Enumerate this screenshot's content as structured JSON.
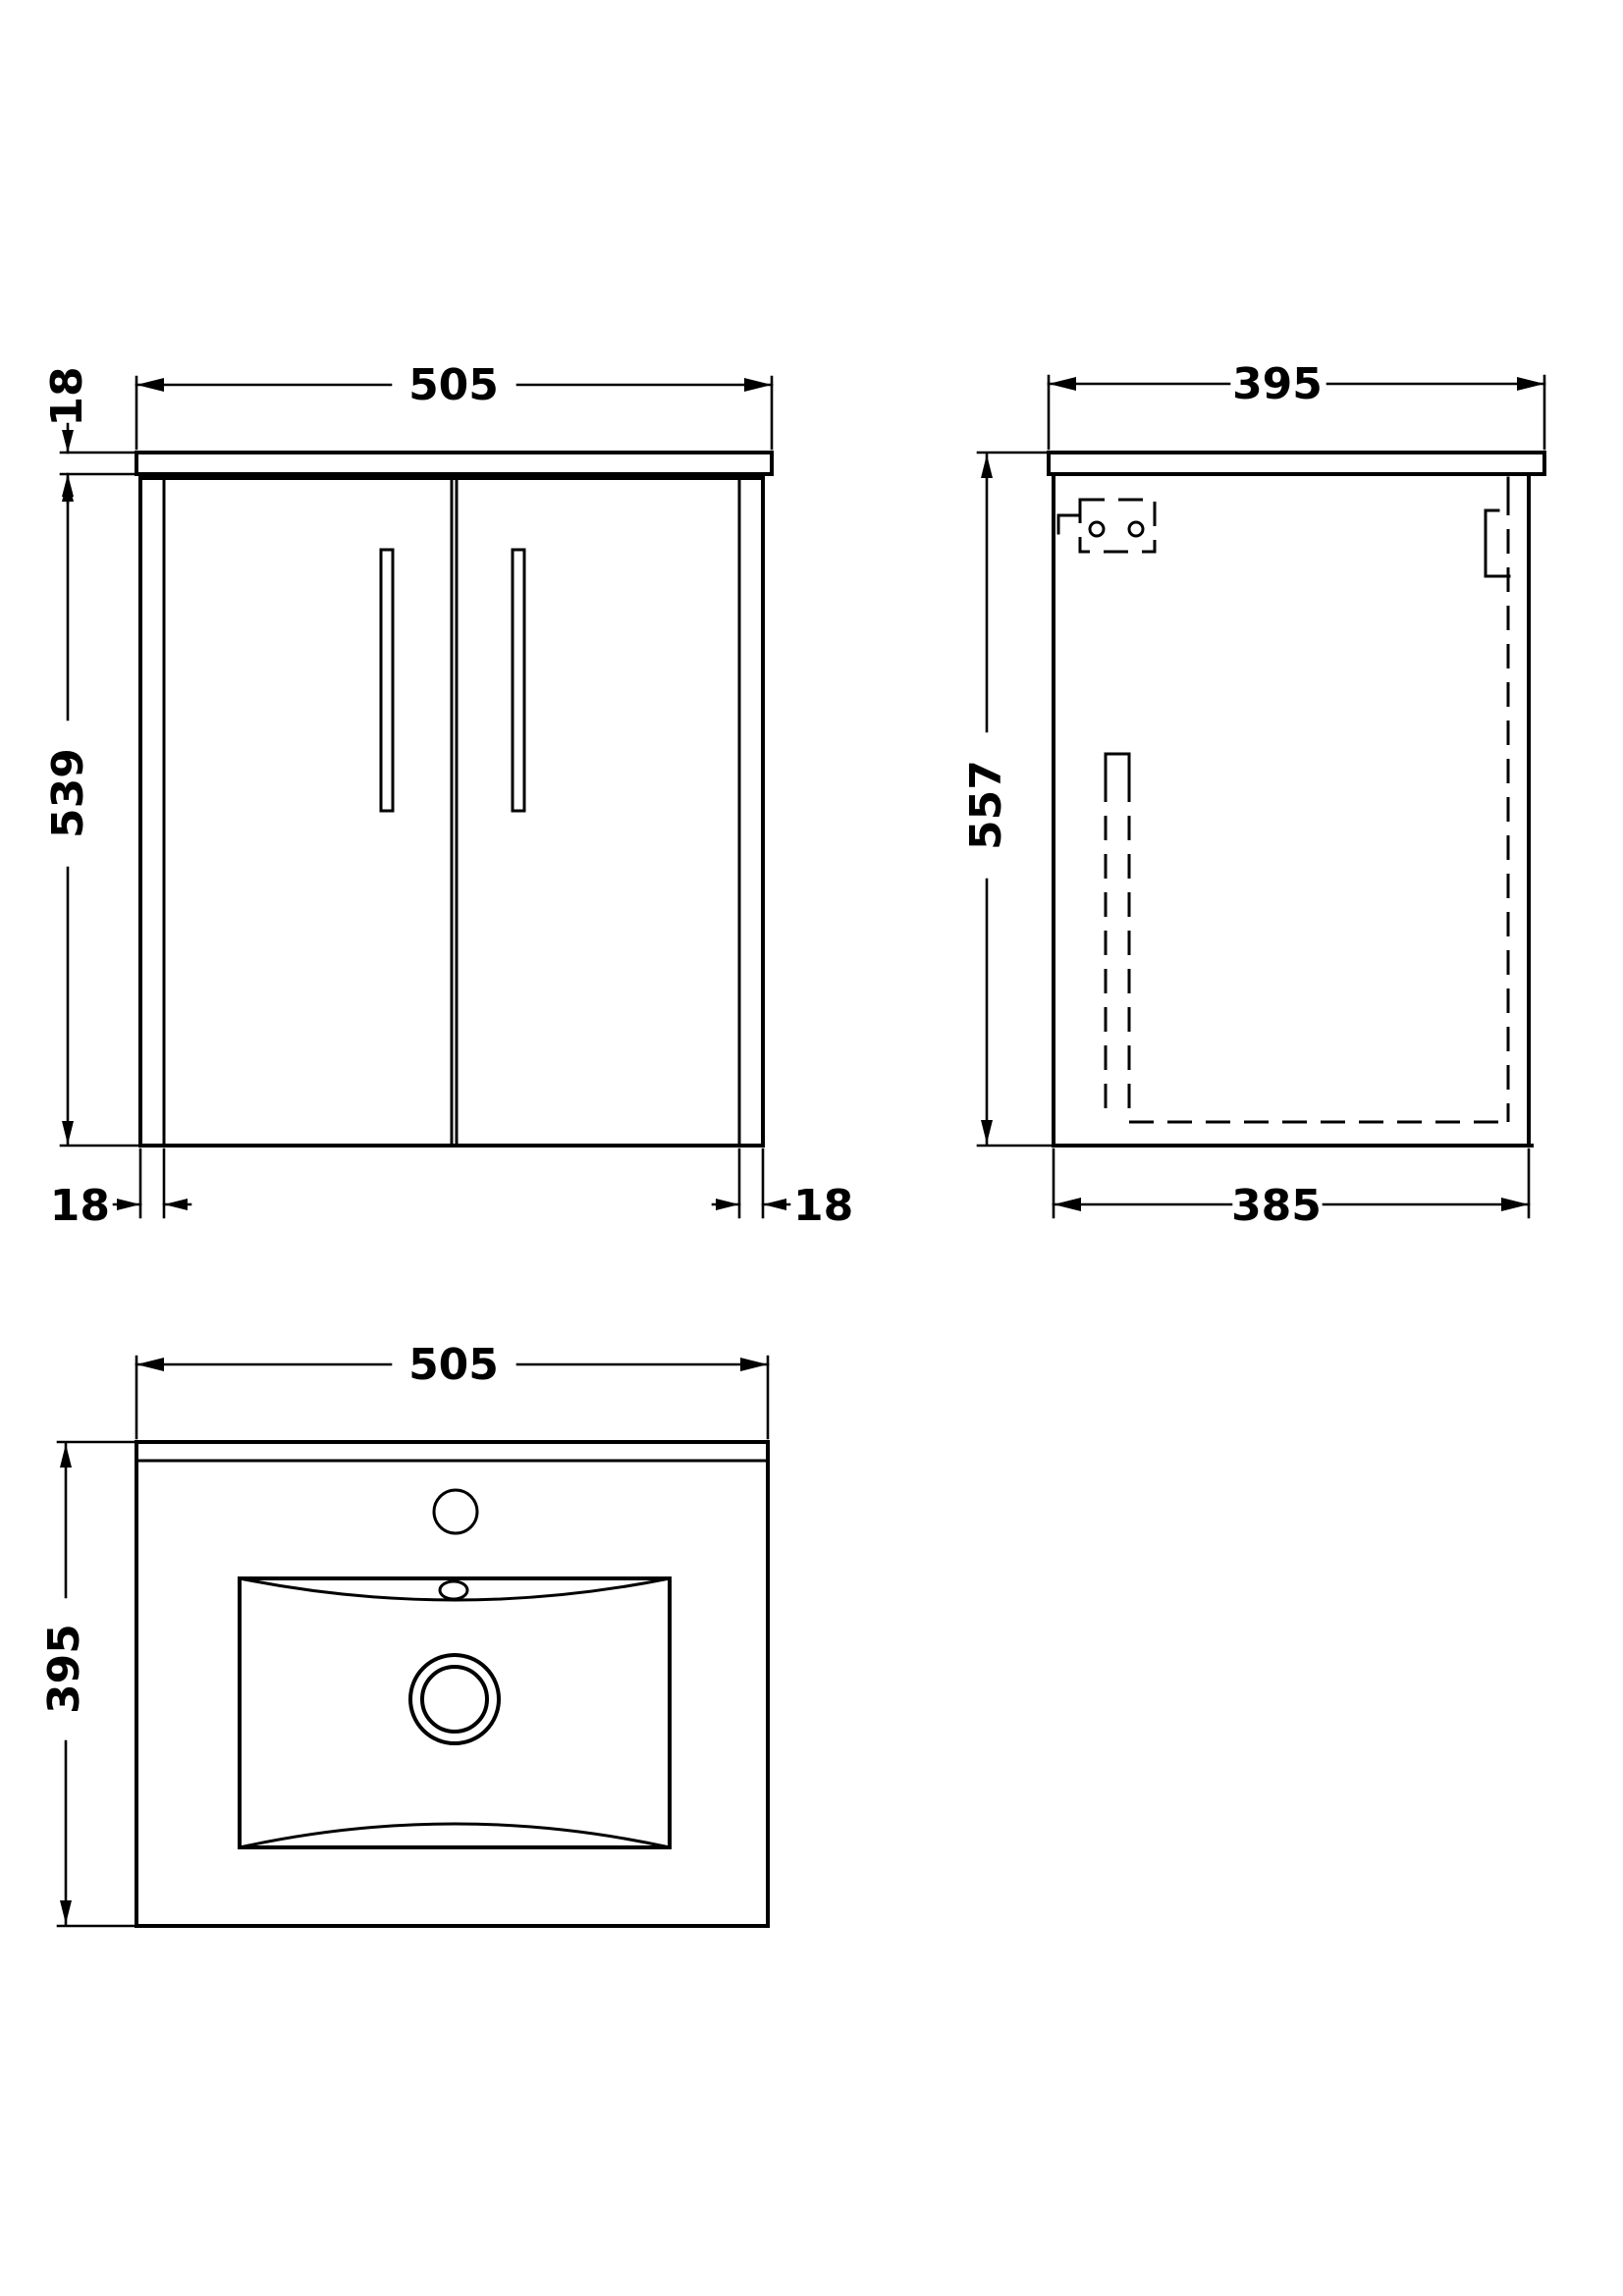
{
  "drawing": {
    "front_view": {
      "width_label": "505",
      "worktop_thickness_label": "18",
      "cabinet_height_label": "539",
      "left_panel_label": "18",
      "right_panel_label": "18"
    },
    "side_view": {
      "depth_label": "395",
      "height_label": "557",
      "cabinet_depth_label": "385"
    },
    "plan_view": {
      "width_label": "505",
      "depth_label": "395"
    }
  }
}
